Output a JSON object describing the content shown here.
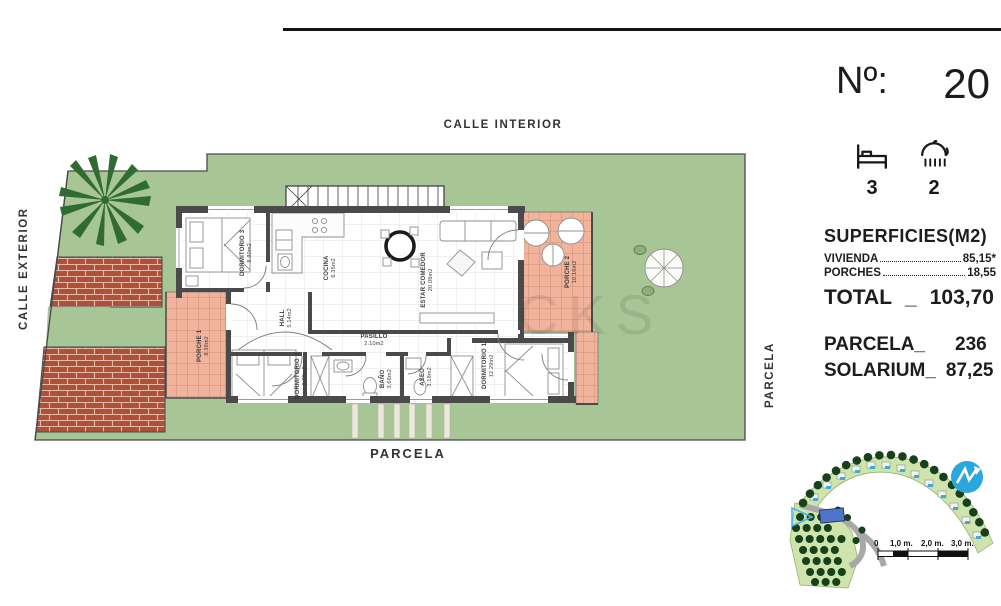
{
  "page": {
    "top_street": "CALLE INTERIOR",
    "left_street": "CALLE EXTERIOR",
    "right_boundary": "PARCELA",
    "bottom_boundary": "PARCELA",
    "watermark": "CKS"
  },
  "unit": {
    "number_label": "Nº:",
    "number": "20",
    "bedrooms": "3",
    "bathrooms": "2"
  },
  "surfaces": {
    "title": "SUPERFICIES(M2)",
    "rows": [
      {
        "label": "VIVIENDA",
        "value": "85,15*"
      },
      {
        "label": "PORCHES",
        "value": "18,55"
      }
    ],
    "total": {
      "label": "TOTAL",
      "sep": "_",
      "value": "103,70"
    },
    "parcela": {
      "label": "PARCELA_",
      "value": "236"
    },
    "solarium": {
      "label": "SOLARIUM_",
      "value": "87,25"
    }
  },
  "rooms": {
    "dormitorio3": {
      "name": "DORMITORIO 3",
      "area": "8.90m2"
    },
    "cocina": {
      "name": "COCINA",
      "area": "6.35m2"
    },
    "estar_comedor": {
      "name": "ESTAR COMEDOR",
      "area": "20.08m2"
    },
    "porche2": {
      "name": "PORCHE 2",
      "area": "10.16m2"
    },
    "porche1": {
      "name": "PORCHE 1",
      "area": "8.39m2"
    },
    "hall": {
      "name": "HALL",
      "area": "5.14m2"
    },
    "pasillo": {
      "name": "PASILLO",
      "area": "2.10m2"
    },
    "dormitorio2": {
      "name": "DORMITORIO 2",
      "area": "9.28m2"
    },
    "bano": {
      "name": "BAÑO",
      "area": "3.68m2"
    },
    "aseo": {
      "name": "ASEO",
      "area": "3.18m2"
    },
    "dormitorio1": {
      "name": "DORMITORIO 1",
      "area": "12.29m2"
    }
  },
  "sitemap": {
    "scale_labels": [
      "0",
      "1,0 m.",
      "2,0 m.",
      "3,0 m."
    ]
  },
  "colors": {
    "garden": "#a7c595",
    "brick": "#b0503a",
    "porch_tile": "#f2b39c",
    "wall": "#4a4a4a",
    "accent_blue": "#2aa7de",
    "plot_highlight": "#4f74c9"
  }
}
